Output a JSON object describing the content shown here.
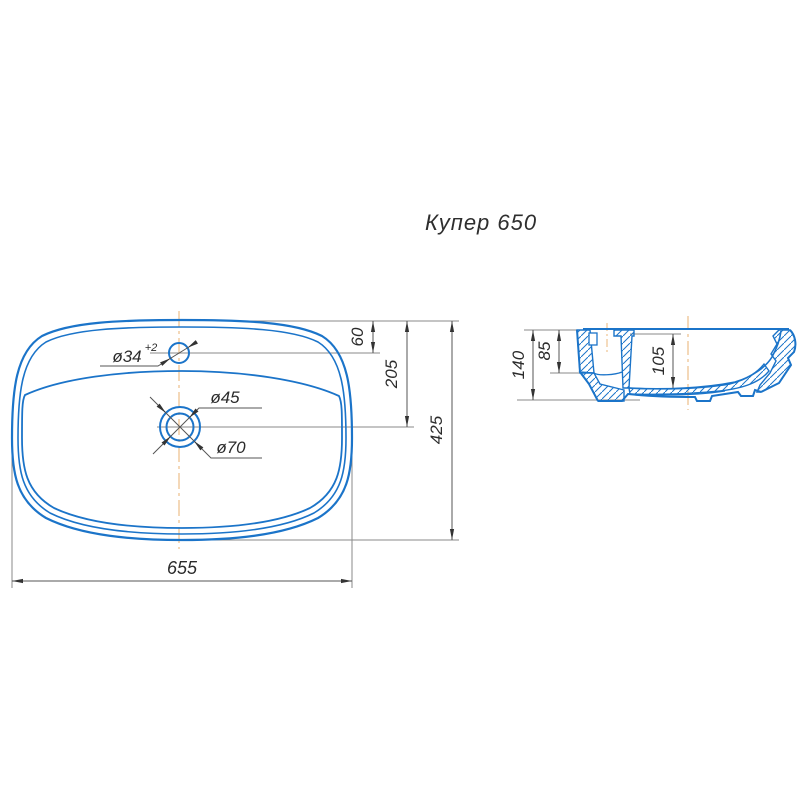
{
  "title": "Купер 650",
  "colors": {
    "outline_blue": "#1b74c9",
    "centerline_tan": "#eec391",
    "dimension_line": "#555555",
    "extension_line": "#8a8a8a",
    "text_dark": "#2b2b2b"
  },
  "top_view": {
    "dimensions": {
      "width": "655",
      "height": "425",
      "faucet_center_from_top": "60",
      "drain_center_from_top": "205",
      "faucet_hole_diameter": "ø34",
      "faucet_hole_tolerance": "+2",
      "drain_inner_diameter": "ø45",
      "drain_outer_diameter": "ø70"
    }
  },
  "side_view": {
    "dimensions": {
      "overall_height": "140",
      "back_channel_depth": "85",
      "bowl_depth": "105"
    }
  }
}
